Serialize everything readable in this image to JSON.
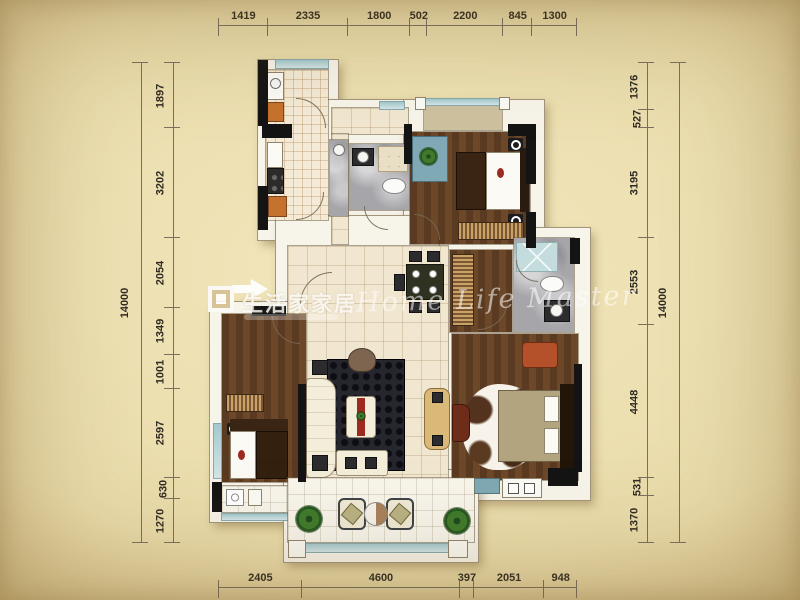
{
  "meta": {
    "kind": "apartment-floor-plan"
  },
  "dimensions": {
    "top": [
      "1419",
      "2335",
      "1800",
      "502",
      "2200",
      "845",
      "1300"
    ],
    "bottom": [
      "2405",
      "4600",
      "397",
      "2051",
      "948"
    ],
    "left": [
      "1897",
      "3202",
      "2054",
      "1349",
      "1001",
      "2597",
      "630",
      "1270"
    ],
    "right": [
      "1376",
      "527",
      "3195",
      "2553",
      "4448",
      "531",
      "1370"
    ],
    "left_total": "14000",
    "right_total": "14000"
  },
  "watermarks": {
    "logo_text": "生活家家居",
    "script_text": "Home Life Master"
  },
  "colors": {
    "paper_center": "#f2e7bd",
    "paper_mid": "#e9dbaa",
    "paper_edge": "#d6c088",
    "paper_corner": "#bfa263",
    "dim_line": "#7a7060",
    "dim_text": "#2f2b23",
    "wall_white": "#f7f4ea",
    "wall_black": "#141414",
    "tile": "#f4ead6",
    "tile_large": "#f1e7d1",
    "wood": "#5a3a20",
    "wood_light": "#6d4828",
    "marble": "#a6a6aa",
    "glass_teal": "#a3c8cd",
    "furniture_teal": "#7fa9b4",
    "rug_black": "#26262e",
    "balcony_tan": "#cdc1a0",
    "cabinet_orange": "#c5722e",
    "accent_red": "#9c2a1e",
    "sofa_cream": "#f3edda",
    "bed_khaki": "#b3a480",
    "chair_orange": "#b4502a",
    "plant_green": "#3f7a2c"
  }
}
